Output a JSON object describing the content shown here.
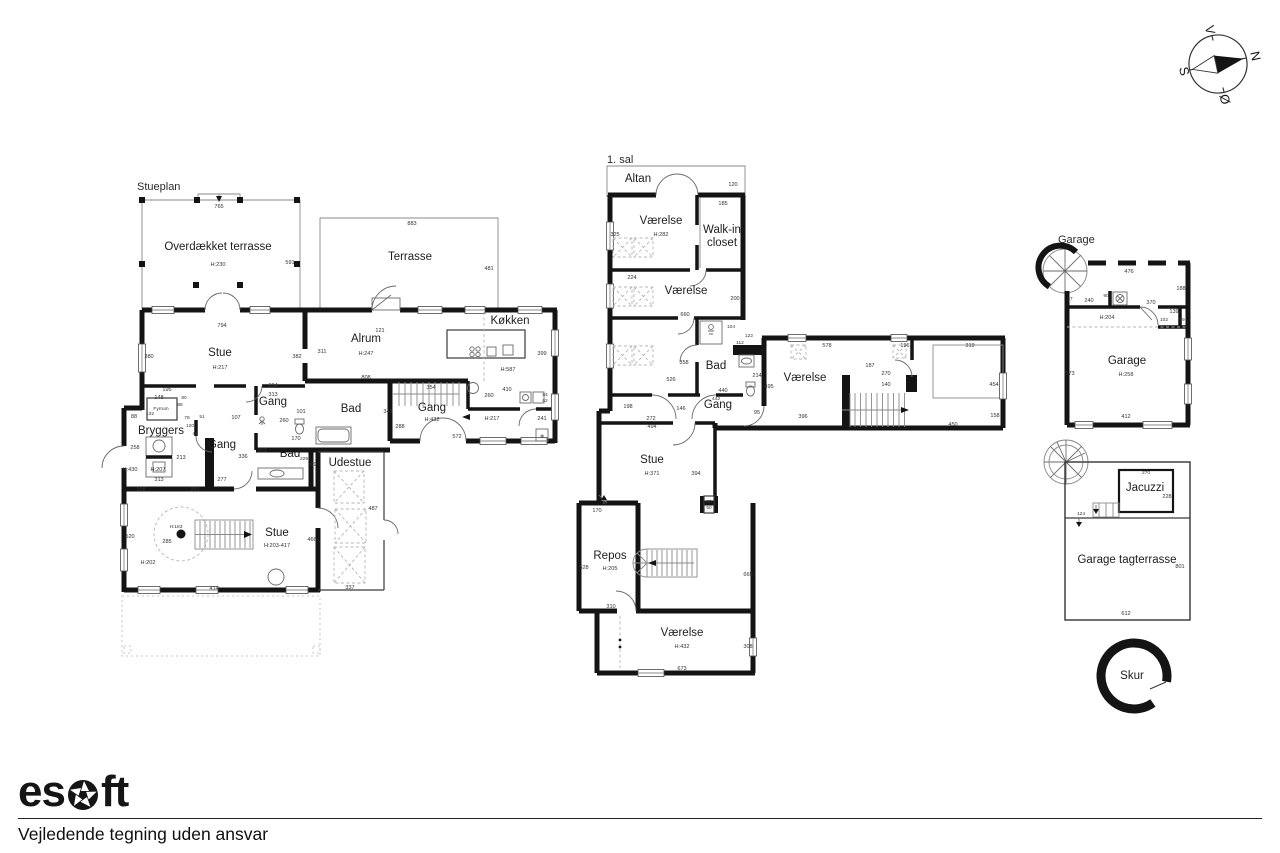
{
  "footer": {
    "logo_left": "es",
    "logo_right": "ft",
    "disclaimer": "Vejledende tegning uden ansvar"
  },
  "compass": {
    "letters": [
      {
        "text": "N",
        "x": 1218,
        "y": 30,
        "cls": "compassletter"
      },
      {
        "text": "S",
        "x": 1218,
        "y": 103,
        "cls": "compassletter"
      },
      {
        "text": "Ø",
        "x": 1254,
        "y": 69,
        "cls": "compassletter"
      },
      {
        "text": "V",
        "x": 1183,
        "y": 69,
        "cls": "compassletter"
      }
    ]
  },
  "stueplan": {
    "title": "Stueplan",
    "labels": [
      {
        "text": "Stueplan",
        "x": 137,
        "y": 190,
        "cls": "title"
      },
      {
        "text": "765",
        "x": 219,
        "y": 208,
        "cls": "dim"
      },
      {
        "text": "Overdækket terrasse",
        "x": 218,
        "y": 250,
        "cls": "room"
      },
      {
        "text": "H:230",
        "x": 218,
        "y": 266,
        "cls": "dim"
      },
      {
        "text": "591",
        "x": 290,
        "y": 264,
        "cls": "dim"
      },
      {
        "text": "Terrasse",
        "x": 410,
        "y": 260,
        "cls": "room"
      },
      {
        "text": "883",
        "x": 412,
        "y": 225,
        "cls": "dim"
      },
      {
        "text": "481",
        "x": 489,
        "y": 270,
        "cls": "dim"
      },
      {
        "text": "794",
        "x": 222,
        "y": 327,
        "cls": "dim"
      },
      {
        "text": "121",
        "x": 380,
        "y": 332,
        "cls": "dim"
      },
      {
        "text": "380",
        "x": 149,
        "y": 358,
        "cls": "dim"
      },
      {
        "text": "Stue",
        "x": 220,
        "y": 356,
        "cls": "room"
      },
      {
        "text": "H:217",
        "x": 220,
        "y": 369,
        "cls": "dim"
      },
      {
        "text": "382",
        "x": 297,
        "y": 358,
        "cls": "dim"
      },
      {
        "text": "311",
        "x": 322,
        "y": 353,
        "cls": "dim"
      },
      {
        "text": "Alrum",
        "x": 366,
        "y": 342,
        "cls": "room"
      },
      {
        "text": "H:247",
        "x": 366,
        "y": 355,
        "cls": "dim"
      },
      {
        "text": "Køkken",
        "x": 510,
        "y": 324,
        "cls": "room"
      },
      {
        "text": "399",
        "x": 542,
        "y": 355,
        "cls": "dim"
      },
      {
        "text": "H:587",
        "x": 508,
        "y": 371,
        "cls": "dim"
      },
      {
        "text": "808",
        "x": 366,
        "y": 379,
        "cls": "dim"
      },
      {
        "text": "304",
        "x": 273,
        "y": 387,
        "cls": "dim"
      },
      {
        "text": "313",
        "x": 273,
        "y": 396,
        "cls": "dim"
      },
      {
        "text": "Gang",
        "x": 273,
        "y": 405,
        "cls": "room"
      },
      {
        "text": "354",
        "x": 431,
        "y": 389,
        "cls": "dim"
      },
      {
        "text": "410",
        "x": 507,
        "y": 391,
        "cls": "dim"
      },
      {
        "text": "260",
        "x": 489,
        "y": 397,
        "cls": "dim"
      },
      {
        "text": "64",
        "x": 545,
        "y": 396,
        "cls": "tiny"
      },
      {
        "text": "62",
        "x": 545,
        "y": 402,
        "cls": "tiny"
      },
      {
        "text": "Gang",
        "x": 432,
        "y": 411,
        "cls": "room"
      },
      {
        "text": "H:432",
        "x": 432,
        "y": 421,
        "cls": "dim"
      },
      {
        "text": "288",
        "x": 400,
        "y": 428,
        "cls": "dim"
      },
      {
        "text": "H:217",
        "x": 492,
        "y": 420,
        "cls": "dim"
      },
      {
        "text": "241",
        "x": 542,
        "y": 420,
        "cls": "dim"
      },
      {
        "text": "572",
        "x": 457,
        "y": 438,
        "cls": "dim"
      },
      {
        "text": "195",
        "x": 167,
        "y": 391,
        "cls": "dim"
      },
      {
        "text": "148",
        "x": 159,
        "y": 399,
        "cls": "dim"
      },
      {
        "text": "80",
        "x": 184,
        "y": 399,
        "cls": "tiny"
      },
      {
        "text": "88",
        "x": 180,
        "y": 406,
        "cls": "tiny"
      },
      {
        "text": "Fyrrum",
        "x": 161,
        "y": 410,
        "cls": "tiny"
      },
      {
        "text": "132",
        "x": 150,
        "y": 415,
        "cls": "tiny"
      },
      {
        "text": "88",
        "x": 134,
        "y": 418,
        "cls": "dim"
      },
      {
        "text": "78",
        "x": 187,
        "y": 419,
        "cls": "tiny"
      },
      {
        "text": "51",
        "x": 202,
        "y": 418,
        "cls": "tiny"
      },
      {
        "text": "107",
        "x": 236,
        "y": 419,
        "cls": "dim"
      },
      {
        "text": "120",
        "x": 190,
        "y": 427,
        "cls": "tiny"
      },
      {
        "text": "44",
        "x": 195,
        "y": 435,
        "cls": "tiny"
      },
      {
        "text": "Bryggers",
        "x": 161,
        "y": 434,
        "cls": "room"
      },
      {
        "text": "258",
        "x": 135,
        "y": 449,
        "cls": "dim"
      },
      {
        "text": "Gang",
        "x": 222,
        "y": 448,
        "cls": "room"
      },
      {
        "text": "213",
        "x": 181,
        "y": 459,
        "cls": "dim"
      },
      {
        "text": "336",
        "x": 243,
        "y": 458,
        "cls": "dim"
      },
      {
        "text": "303",
        "x": 262,
        "y": 452,
        "cls": "dim"
      },
      {
        "text": "Bad",
        "x": 290,
        "y": 457,
        "cls": "room"
      },
      {
        "text": "229",
        "x": 304,
        "y": 460,
        "cls": "tiny"
      },
      {
        "text": "109",
        "x": 312,
        "y": 466,
        "cls": "dim"
      },
      {
        "text": "H:430",
        "x": 130,
        "y": 471,
        "cls": "dim"
      },
      {
        "text": "H:207",
        "x": 158,
        "y": 471,
        "cls": "dim"
      },
      {
        "text": "313",
        "x": 159,
        "y": 481,
        "cls": "dim"
      },
      {
        "text": "277",
        "x": 222,
        "y": 481,
        "cls": "dim"
      },
      {
        "text": "158",
        "x": 141,
        "y": 491,
        "cls": "dim"
      },
      {
        "text": "291",
        "x": 195,
        "y": 491,
        "cls": "dim"
      },
      {
        "text": "101",
        "x": 301,
        "y": 413,
        "cls": "dim"
      },
      {
        "text": "260",
        "x": 284,
        "y": 422,
        "cls": "dim"
      },
      {
        "text": "170",
        "x": 296,
        "y": 440,
        "cls": "dim"
      },
      {
        "text": "Bad",
        "x": 351,
        "y": 412,
        "cls": "room"
      },
      {
        "text": "341",
        "x": 388,
        "y": 413,
        "cls": "dim"
      },
      {
        "text": "Udestue",
        "x": 350,
        "y": 466,
        "cls": "room"
      },
      {
        "text": "487",
        "x": 373,
        "y": 510,
        "cls": "dim"
      },
      {
        "text": "H:183",
        "x": 176,
        "y": 528,
        "cls": "tiny"
      },
      {
        "text": "285",
        "x": 167,
        "y": 543,
        "cls": "dim"
      },
      {
        "text": "Stue",
        "x": 277,
        "y": 536,
        "cls": "room"
      },
      {
        "text": "H:203-417",
        "x": 277,
        "y": 547,
        "cls": "dim"
      },
      {
        "text": "466",
        "x": 312,
        "y": 541,
        "cls": "dim"
      },
      {
        "text": "H:202",
        "x": 148,
        "y": 564,
        "cls": "dim"
      },
      {
        "text": "520",
        "x": 130,
        "y": 538,
        "cls": "dim"
      },
      {
        "text": "414",
        "x": 214,
        "y": 590,
        "cls": "dim"
      },
      {
        "text": "337",
        "x": 350,
        "y": 589,
        "cls": "dim"
      },
      {
        "text": "❄",
        "x": 542,
        "y": 438,
        "cls": "tiny"
      }
    ]
  },
  "first_floor": {
    "title": "1. sal",
    "labels": [
      {
        "text": "1. sal",
        "x": 607,
        "y": 163,
        "cls": "title"
      },
      {
        "text": "Altan",
        "x": 638,
        "y": 182,
        "cls": "room"
      },
      {
        "text": "120",
        "x": 733,
        "y": 186,
        "cls": "dim"
      },
      {
        "text": "185",
        "x": 723,
        "y": 205,
        "cls": "dim"
      },
      {
        "text": "Værelse",
        "x": 661,
        "y": 224,
        "cls": "room"
      },
      {
        "text": "H:282",
        "x": 661,
        "y": 236,
        "cls": "dim"
      },
      {
        "text": "325",
        "x": 615,
        "y": 236,
        "cls": "dim"
      },
      {
        "text": "Walk-in",
        "x": 722,
        "y": 233,
        "cls": "room"
      },
      {
        "text": "closet",
        "x": 722,
        "y": 246,
        "cls": "room"
      },
      {
        "text": "224",
        "x": 632,
        "y": 279,
        "cls": "dim"
      },
      {
        "text": "Værelse",
        "x": 686,
        "y": 294,
        "cls": "room"
      },
      {
        "text": "200",
        "x": 735,
        "y": 300,
        "cls": "dim"
      },
      {
        "text": "660",
        "x": 685,
        "y": 316,
        "cls": "dim"
      },
      {
        "text": "104",
        "x": 731,
        "y": 328,
        "cls": "tiny"
      },
      {
        "text": "122",
        "x": 749,
        "y": 337,
        "cls": "tiny"
      },
      {
        "text": "112",
        "x": 740,
        "y": 344,
        "cls": "tiny"
      },
      {
        "text": "358",
        "x": 684,
        "y": 364,
        "cls": "dim"
      },
      {
        "text": "Bad",
        "x": 716,
        "y": 369,
        "cls": "room"
      },
      {
        "text": "526",
        "x": 671,
        "y": 381,
        "cls": "dim"
      },
      {
        "text": "214",
        "x": 757,
        "y": 377,
        "cls": "dim"
      },
      {
        "text": "495",
        "x": 769,
        "y": 388,
        "cls": "dim"
      },
      {
        "text": "440",
        "x": 723,
        "y": 392,
        "cls": "dim"
      },
      {
        "text": "442",
        "x": 716,
        "y": 400,
        "cls": "tiny"
      },
      {
        "text": "Gang",
        "x": 718,
        "y": 408,
        "cls": "room"
      },
      {
        "text": "146",
        "x": 681,
        "y": 410,
        "cls": "dim"
      },
      {
        "text": "198",
        "x": 628,
        "y": 408,
        "cls": "dim"
      },
      {
        "text": "272",
        "x": 651,
        "y": 420,
        "cls": "dim"
      },
      {
        "text": "494",
        "x": 652,
        "y": 428,
        "cls": "dim"
      },
      {
        "text": "95",
        "x": 757,
        "y": 414,
        "cls": "dim"
      },
      {
        "text": "578",
        "x": 827,
        "y": 347,
        "cls": "dim"
      },
      {
        "text": "196",
        "x": 905,
        "y": 347,
        "cls": "dim"
      },
      {
        "text": "319",
        "x": 970,
        "y": 347,
        "cls": "dim"
      },
      {
        "text": "Værelse",
        "x": 805,
        "y": 381,
        "cls": "room"
      },
      {
        "text": "187",
        "x": 870,
        "y": 367,
        "cls": "dim"
      },
      {
        "text": "270",
        "x": 886,
        "y": 375,
        "cls": "dim"
      },
      {
        "text": "140",
        "x": 886,
        "y": 386,
        "cls": "dim"
      },
      {
        "text": "454",
        "x": 994,
        "y": 386,
        "cls": "dim"
      },
      {
        "text": "396",
        "x": 803,
        "y": 418,
        "cls": "dim"
      },
      {
        "text": "158",
        "x": 995,
        "y": 417,
        "cls": "dim"
      },
      {
        "text": "450",
        "x": 953,
        "y": 426,
        "cls": "dim"
      },
      {
        "text": "Stue",
        "x": 652,
        "y": 463,
        "cls": "room"
      },
      {
        "text": "H:371",
        "x": 652,
        "y": 475,
        "cls": "dim"
      },
      {
        "text": "394",
        "x": 696,
        "y": 475,
        "cls": "dim"
      },
      {
        "text": "60",
        "x": 709,
        "y": 503,
        "cls": "tiny"
      },
      {
        "text": "50",
        "x": 709,
        "y": 509,
        "cls": "tiny"
      },
      {
        "text": "170",
        "x": 597,
        "y": 512,
        "cls": "dim"
      },
      {
        "text": "Repos",
        "x": 610,
        "y": 559,
        "cls": "room"
      },
      {
        "text": "H:205",
        "x": 610,
        "y": 570,
        "cls": "dim"
      },
      {
        "text": "528",
        "x": 584,
        "y": 569,
        "cls": "dim"
      },
      {
        "text": "665",
        "x": 748,
        "y": 576,
        "cls": "dim"
      },
      {
        "text": "310",
        "x": 611,
        "y": 608,
        "cls": "dim"
      },
      {
        "text": "Værelse",
        "x": 682,
        "y": 636,
        "cls": "room"
      },
      {
        "text": "H:432",
        "x": 682,
        "y": 648,
        "cls": "dim"
      },
      {
        "text": "308",
        "x": 748,
        "y": 648,
        "cls": "dim"
      },
      {
        "text": "673",
        "x": 682,
        "y": 670,
        "cls": "dim"
      }
    ]
  },
  "garage_plan": {
    "title": "Garage",
    "labels": [
      {
        "text": "Garage",
        "x": 1058,
        "y": 243,
        "cls": "title"
      },
      {
        "text": "476",
        "x": 1129,
        "y": 273,
        "cls": "dim"
      },
      {
        "text": "188",
        "x": 1181,
        "y": 290,
        "cls": "dim"
      },
      {
        "text": "57",
        "x": 1070,
        "y": 300,
        "cls": "tiny"
      },
      {
        "text": "240",
        "x": 1089,
        "y": 302,
        "cls": "dim"
      },
      {
        "text": "90",
        "x": 1106,
        "y": 297,
        "cls": "tiny"
      },
      {
        "text": "370",
        "x": 1151,
        "y": 304,
        "cls": "dim"
      },
      {
        "text": "139",
        "x": 1174,
        "y": 313,
        "cls": "dim"
      },
      {
        "text": "H:204",
        "x": 1107,
        "y": 319,
        "cls": "dim"
      },
      {
        "text": "102",
        "x": 1164,
        "y": 321,
        "cls": "tiny"
      },
      {
        "text": "79",
        "x": 1182,
        "y": 321,
        "cls": "tiny"
      },
      {
        "text": "Garage",
        "x": 1127,
        "y": 364,
        "cls": "room"
      },
      {
        "text": "H:258",
        "x": 1126,
        "y": 376,
        "cls": "dim"
      },
      {
        "text": "573",
        "x": 1070,
        "y": 375,
        "cls": "dim"
      },
      {
        "text": "412",
        "x": 1126,
        "y": 418,
        "cls": "dim"
      }
    ]
  },
  "roof_terrace": {
    "labels": [
      {
        "text": "270",
        "x": 1146,
        "y": 474,
        "cls": "tiny"
      },
      {
        "text": "Jacuzzi",
        "x": 1145,
        "y": 491,
        "cls": "room"
      },
      {
        "text": "228",
        "x": 1167,
        "y": 498,
        "cls": "dim"
      },
      {
        "text": "124",
        "x": 1081,
        "y": 515,
        "cls": "tiny"
      },
      {
        "text": "Garage tagterrasse",
        "x": 1127,
        "y": 563,
        "cls": "room"
      },
      {
        "text": "801",
        "x": 1180,
        "y": 568,
        "cls": "dim"
      },
      {
        "text": "612",
        "x": 1126,
        "y": 615,
        "cls": "dim"
      }
    ]
  },
  "shed": {
    "labels": [
      {
        "text": "Skur",
        "x": 1132,
        "y": 679,
        "cls": "room"
      }
    ]
  }
}
